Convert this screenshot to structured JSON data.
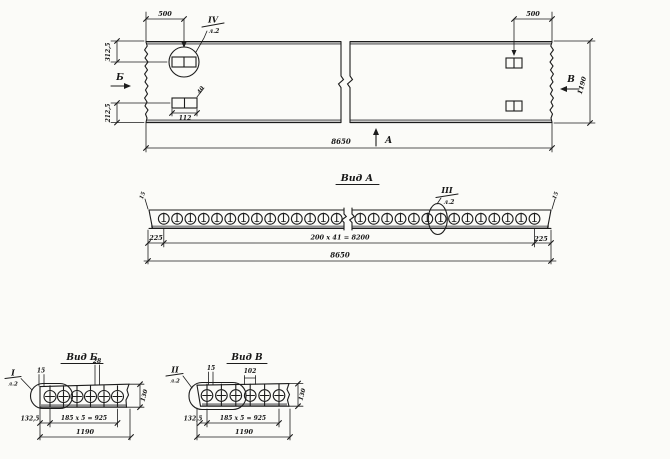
{
  "plan": {
    "dim_500_left": "500",
    "dim_500_right": "500",
    "dim_312_5": "312,5",
    "dim_212_5": "212,5",
    "dim_112": "112",
    "dim_40": "40",
    "dim_1190": "1190",
    "dim_8650": "8650",
    "section_arrow_b": "Б",
    "section_arrow_v": "В",
    "section_arrow_a": "А",
    "callout": {
      "num": "IV",
      "sheet": "л.2"
    }
  },
  "view_a": {
    "title": "Вид А",
    "dim_15_left": "15",
    "dim_15_right": "15",
    "dim_225_left": "225",
    "dim_225_right": "225",
    "dim_holes": "200 x 41 = 8200",
    "dim_8650": "8650",
    "callout": {
      "num": "III",
      "sheet": "л.2"
    }
  },
  "view_b": {
    "title": "Вид Б",
    "callout": {
      "num": "I",
      "sheet": "л.2"
    },
    "dim_15": "15",
    "dim_28": "28",
    "dim_130": "130",
    "dim_132_5": "132,5",
    "dim_holes": "185 x 5 = 925",
    "dim_1190": "1190"
  },
  "view_v": {
    "title": "Вид В",
    "callout": {
      "num": "II",
      "sheet": "л.2"
    },
    "dim_15": "15",
    "dim_102": "102",
    "dim_130": "130",
    "dim_132_5": "132,5",
    "dim_holes": "185 x 5 = 925",
    "dim_1190": "1190"
  }
}
